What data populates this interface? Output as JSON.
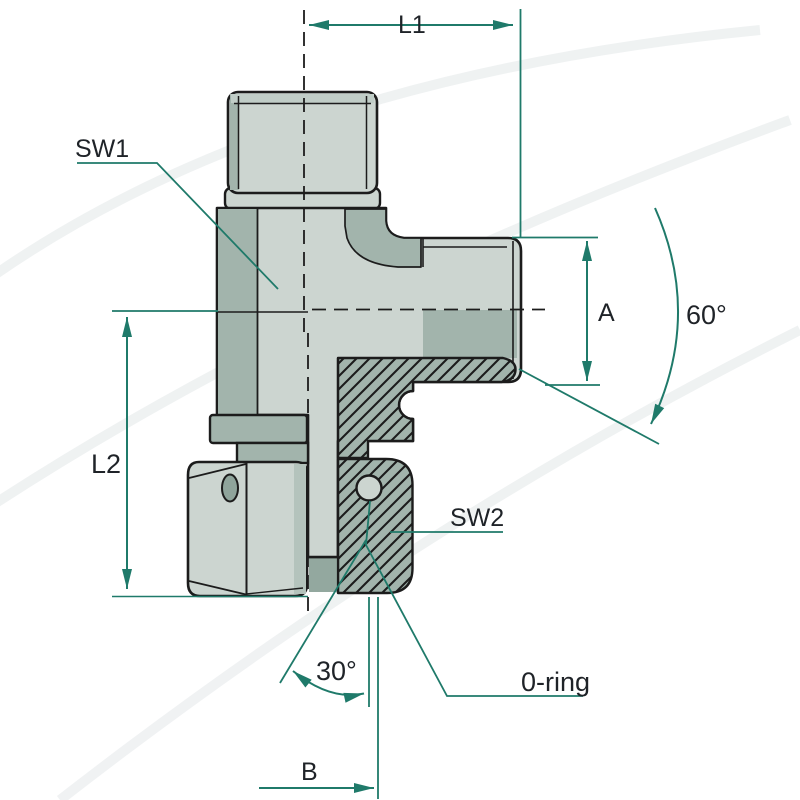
{
  "diagram": {
    "type": "technical-drawing",
    "subject": "Hydraulic banjo elbow fitting cross-section with dimension callouts",
    "labels": {
      "l1": "L1",
      "sw1": "SW1",
      "l2": "L2",
      "a": "A",
      "angle60": "60°",
      "sw2": "SW2",
      "oring": "0-ring",
      "angle30": "30°",
      "b": "B"
    },
    "colors": {
      "dimension_line": "#1f7a6a",
      "label_text": "#1f2328",
      "body_light": "#ccd5d0",
      "body_shaded": "#a2b4ac",
      "body_dark": "#8fa49b",
      "outline": "#1c1c1c",
      "background": "#ffffff"
    }
  }
}
